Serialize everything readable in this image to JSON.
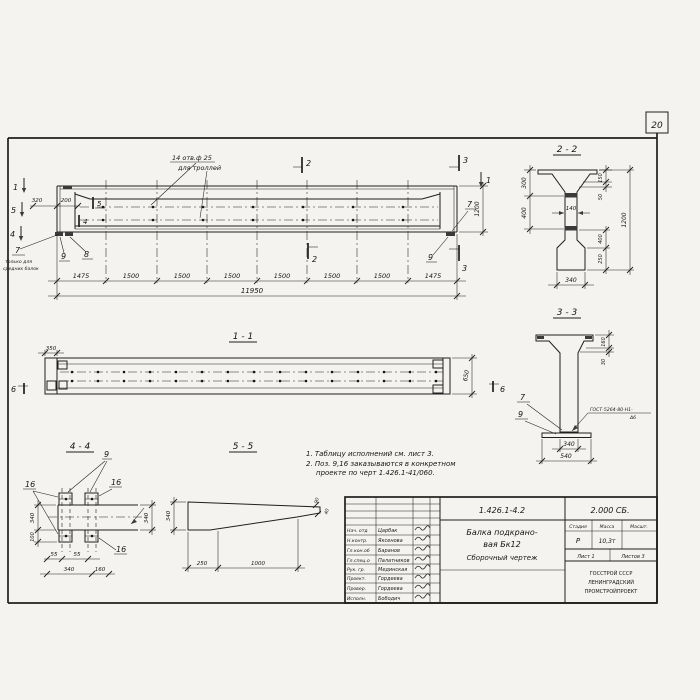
{
  "sheet": {
    "page_number": "20"
  },
  "main_view": {
    "hole_note_line1": "14 отв.ф 25",
    "hole_note_line2": "для троллей",
    "dim_320": "320",
    "dim_200": "200",
    "dim_1200": "1200",
    "chain": [
      "1475",
      "1500",
      "1500",
      "1500",
      "1500",
      "1500",
      "1500",
      "1475"
    ],
    "total": "11950",
    "mark_1_left": "1",
    "mark_5_left": "5",
    "mark_4_left": "4",
    "mark_1_right": "1",
    "mark_2_top": "2",
    "mark_2_bottom": "2",
    "mark_3_top": "3",
    "mark_3_bottom": "3",
    "mark_5_inner": "5",
    "mark_4_inner": "4",
    "callout_7": "7",
    "callout_7_note1": "только для",
    "callout_7_note2": "средних балок",
    "callout_9": "9",
    "callout_8": "8",
    "callout_7_right": "7",
    "callout_9_right": "9"
  },
  "section_2_2": {
    "title": "2 - 2",
    "dim_300": "300",
    "dim_400": "400",
    "dim_140": "140",
    "dim_150": "150",
    "dim_50": "50",
    "dim_1200": "1200",
    "dim_400b": "400",
    "dim_250": "250",
    "dim_340": "340"
  },
  "section_3_3": {
    "title": "3 - 3",
    "dim_160": "160",
    "dim_30": "30",
    "dim_340": "340",
    "dim_540": "540",
    "callout_7": "7",
    "callout_9": "9",
    "weld_note_line1": "ГОСТ-5264-80-Н1-",
    "weld_note_line2": "Δ6"
  },
  "view_1_1": {
    "title": "1 - 1",
    "dim_350": "350",
    "dim_650": "650",
    "mark_6_left": "6",
    "mark_6_right": "6"
  },
  "view_4_4": {
    "title": "4 - 4",
    "callout_9": "9",
    "callout_16_left": "16",
    "callout_16_right": "16",
    "callout_16_bottom": "16",
    "dim_340_left": "340",
    "dim_100": "100",
    "dim_340_right": "340",
    "dim_55_a": "55",
    "dim_55_b": "55",
    "dim_340_bottom": "340",
    "dim_160": "160"
  },
  "view_5_5": {
    "title": "5 - 5",
    "dim_340": "340",
    "dim_250": "250",
    "dim_1000": "1000",
    "dim_90": "90",
    "dim_40": "40"
  },
  "notes": {
    "line1": "1. Таблицу исполнений см. лист 3.",
    "line2": "2. Поз. 9,16 заказываются в конкретном",
    "line3": "проекте по черт 1.426.1-41/060."
  },
  "title_block": {
    "doc_number": "1.426.1-4.2",
    "doc_suffix": "2.000 СБ.",
    "title_line1": "Балка подкрано-",
    "title_line2": "вая Бк12",
    "title_line3": "Сборочный чертеж",
    "header_stage": "Стадия",
    "header_mass": "Масса",
    "header_scale": "Масшт.",
    "value_stage": "Р",
    "value_mass": "10,3т",
    "sheet_label": "Лист 1",
    "sheets_label": "Листов 3",
    "org_line1": "ГОССТРОЙ СССР",
    "org_line2": "ЛЕНИНГРАДСКИЙ",
    "org_line3": "ПРОМСТРОЙПРОЕКТ",
    "rows": [
      {
        "role": "Нач. отд",
        "name": "Царбак"
      },
      {
        "role": "Н.контр.",
        "name": "Яксенова"
      },
      {
        "role": "Гл.кон.об",
        "name": "Баранов"
      },
      {
        "role": "Гл.спец.о",
        "name": "Палатников"
      },
      {
        "role": "Рук. гр.",
        "name": "Мединская"
      },
      {
        "role": "Проект.",
        "name": "Гордеева"
      },
      {
        "role": "Провер.",
        "name": "Гордеева"
      },
      {
        "role": "Исполн.",
        "name": "Бободич"
      }
    ]
  }
}
